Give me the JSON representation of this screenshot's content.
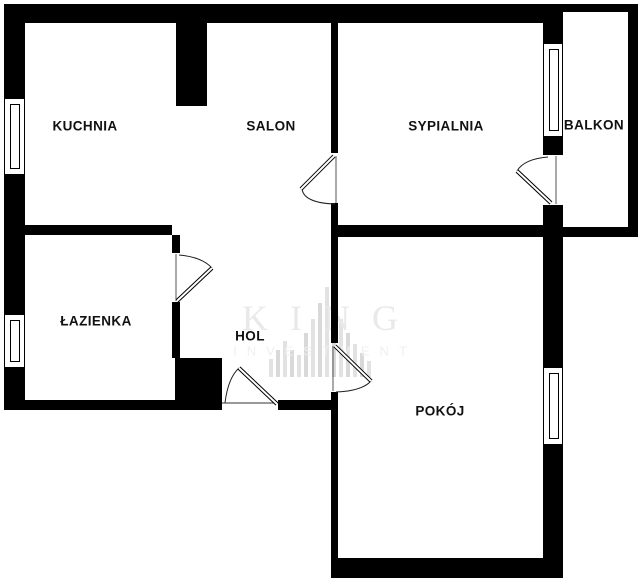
{
  "diagram_type": "apartment-floor-plan",
  "rooms": {
    "kuchnia": {
      "label": "KUCHNIA"
    },
    "salon": {
      "label": "SALON"
    },
    "sypialnia": {
      "label": "SYPIALNIA"
    },
    "balkon": {
      "label": "BALKON"
    },
    "lazienka": {
      "label": "ŁAZIENKA"
    },
    "hol": {
      "label": "HOL"
    },
    "pokoj": {
      "label": "POKÓJ"
    }
  },
  "watermark": {
    "brand": "KING",
    "brand_sub": "INVESTMENT"
  },
  "colors": {
    "wall": "#000000",
    "background": "#ffffff",
    "label_text": "#111111",
    "watermark_text": "#e9e9e9",
    "watermark_logo": "#dddddd"
  }
}
